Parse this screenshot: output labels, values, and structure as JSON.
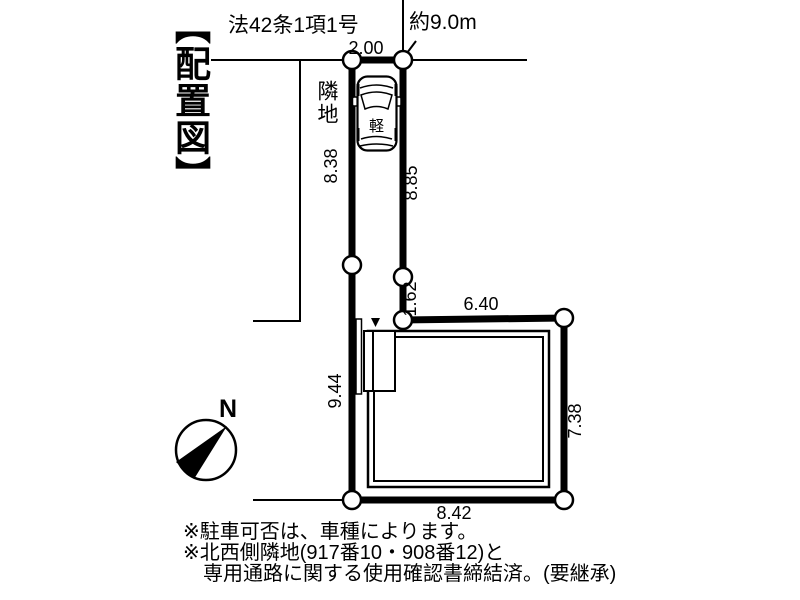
{
  "page": {
    "background": "#ffffff",
    "line_color": "#000000"
  },
  "title": "【配置図】",
  "annotations": {
    "road_law": "法42条1項1号",
    "road_width": "約9.0m",
    "neighbor_label": "隣地",
    "car_label": "軽",
    "north_label": "N"
  },
  "dimensions": {
    "strip_top_width": "2.00",
    "strip_left_upper": "8.38",
    "strip_right": "8.85",
    "strip_right_step": "1.62",
    "main_top": "6.40",
    "main_left": "9.44",
    "main_right": "7.38",
    "main_bottom": "8.42"
  },
  "notes": [
    "※駐車可否は、車種によります。",
    "※北西側隣地(917番10・908番12)と",
    "専用通路に関する使用確認書締結済。(要継承)"
  ]
}
